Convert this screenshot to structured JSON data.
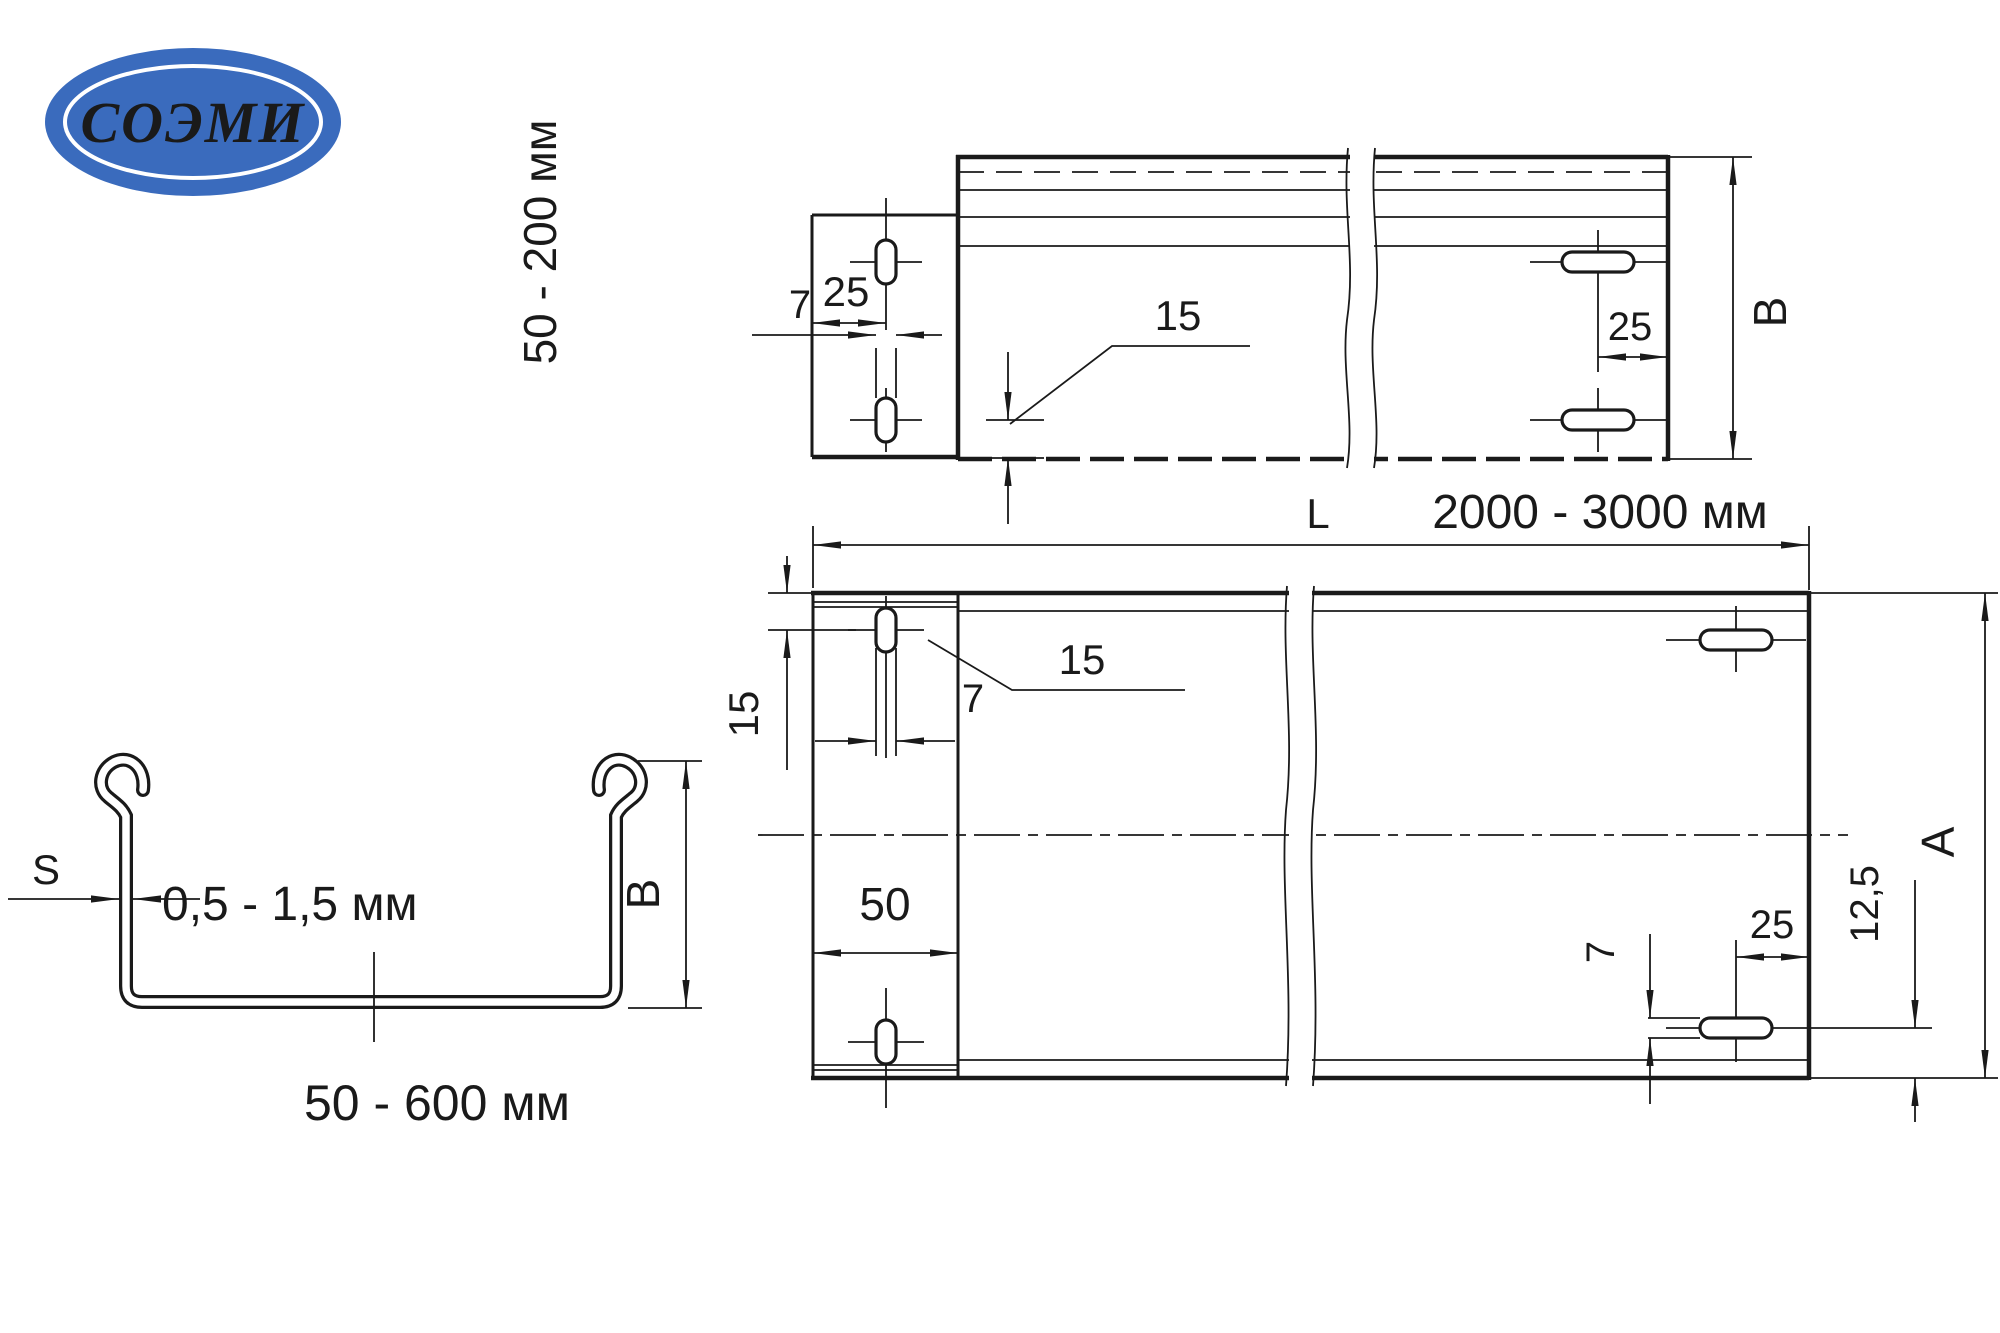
{
  "colors": {
    "line": "#1a1a1a",
    "background": "#ffffff",
    "logo_blue": "#3a6bbd",
    "logo_text": "#ffffff"
  },
  "logo": {
    "text": "СОЭМИ"
  },
  "side_view": {
    "height_range": "50 - 200 мм",
    "dim_tab_hole_offset": "25",
    "dim_hole_width": "7",
    "dim_hole_length": "15",
    "dim_right_hole_offset": "25",
    "dim_height": "В"
  },
  "plan_view": {
    "length_prefix": "L",
    "length_range": "2000 - 3000 мм",
    "dim_edge_to_hole": "15",
    "dim_hole_width_top": "7",
    "dim_hole_length": "15",
    "dim_tab_width": "50",
    "dim_hole_width_bottom": "7",
    "dim_hole_offset": "25",
    "dim_bottom_offset": "12,5",
    "dim_width": "А"
  },
  "section_view": {
    "thickness_symbol": "S",
    "thickness_range": "0,5 - 1,5 мм",
    "width_range": "50 - 600 мм",
    "dim_height": "В"
  }
}
